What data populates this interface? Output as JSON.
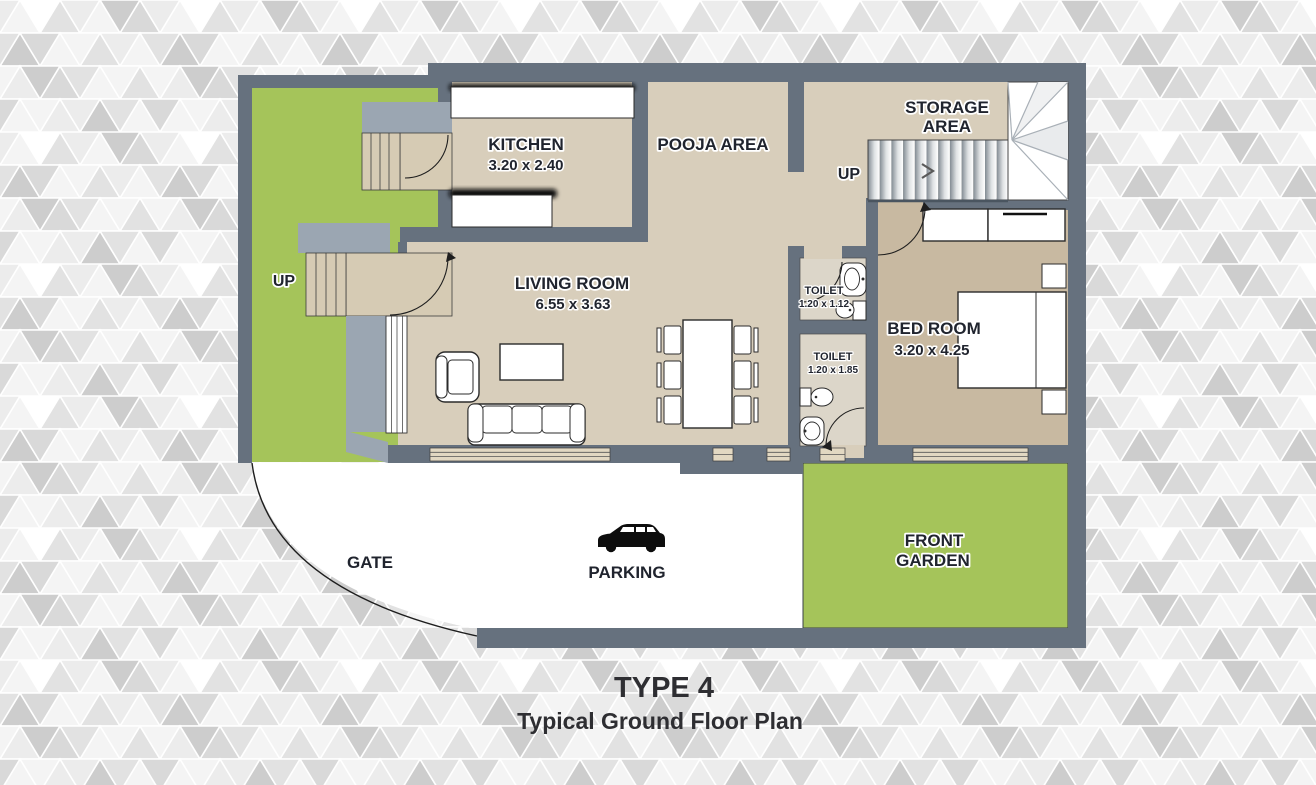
{
  "plan": {
    "kitchen": {
      "label": "KITCHEN",
      "dimensions": "3.20 x 2.40"
    },
    "pooja_area": {
      "label": "POOJA AREA"
    },
    "storage_area": {
      "label_line1": "STORAGE",
      "label_line2": "AREA"
    },
    "stairs": {
      "up_label": "UP"
    },
    "entrance": {
      "up_label": "UP"
    },
    "living_room": {
      "label": "LIVING ROOM",
      "dimensions": "6.55 x 3.63"
    },
    "toilet_small": {
      "label": "TOILET",
      "dimensions": "1.20 x 1.12"
    },
    "toilet_large": {
      "label": "TOILET",
      "dimensions": "1.20 x 1.85"
    },
    "bedroom": {
      "label": "BED ROOM",
      "dimensions": "3.20 x 4.25"
    },
    "gate": {
      "label": "GATE"
    },
    "parking": {
      "label": "PARKING"
    },
    "front_garden": {
      "label_line1": "FRONT",
      "label_line2": "GARDEN"
    }
  },
  "caption": {
    "type": "TYPE 4",
    "subtitle": "Typical Ground Floor Plan"
  },
  "icons": {
    "parking": "car-silhouette",
    "stairs_direction": "chevron-right"
  },
  "colors": {
    "wall": "#66717e",
    "porch_gray": "#9ba6b2",
    "floor": "#d8cebb",
    "bedroom_floor": "#c8b9a1",
    "toilet_floor": "#dcd6c9",
    "garden_green": "#a5c45a",
    "label_ink": "#20242e",
    "title_ink": "#2e2e32"
  }
}
